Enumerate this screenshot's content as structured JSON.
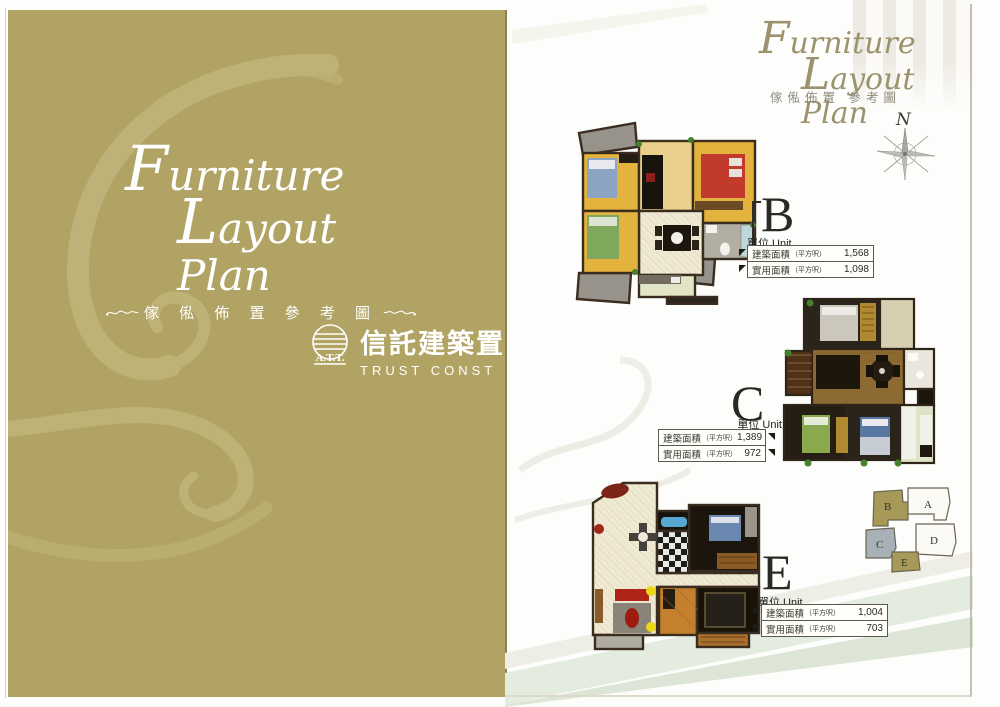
{
  "cover": {
    "title_line1": "Furniture",
    "title_line2": "Layout Plan",
    "subtitle_cjk": "傢 俬 佈 置 參 考 圖",
    "logo": {
      "abbr": "A.T.T.",
      "name_cjk": "信託建築置",
      "name_en": "TRUST CONST"
    },
    "background_color": "#b1a364",
    "ornament_color": "#cabf88"
  },
  "sheet": {
    "title_line1": "Furniture",
    "title_line2": "Layout Plan",
    "subtitle_cjk": "傢俬佈置 參考圖",
    "compass_label": "N",
    "title_color": "#9c926e"
  },
  "units": [
    {
      "letter": "B",
      "unit_label": "單位 Unit",
      "rows": [
        {
          "label": "建築面積",
          "paren": "（平方呎）",
          "value": "1,568"
        },
        {
          "label": "實用面積",
          "paren": "（平方呎）",
          "value": "1,098"
        }
      ]
    },
    {
      "letter": "C",
      "unit_label": "單位 Unit",
      "rows": [
        {
          "label": "建築面積",
          "paren": "（平方呎）",
          "value": "1,389"
        },
        {
          "label": "實用面積",
          "paren": "（平方呎）",
          "value": "972"
        }
      ]
    },
    {
      "letter": "E",
      "unit_label": "單位 Unit",
      "rows": [
        {
          "label": "建築面積",
          "paren": "（平方呎）",
          "value": "1,004"
        },
        {
          "label": "實用面積",
          "paren": "（平方呎）",
          "value": "703"
        }
      ]
    }
  ],
  "keyplan": {
    "letters": [
      "A",
      "B",
      "C",
      "D",
      "E"
    ],
    "highlight_color": "#a79a58",
    "c_unit_color": "#a9b1b8"
  }
}
